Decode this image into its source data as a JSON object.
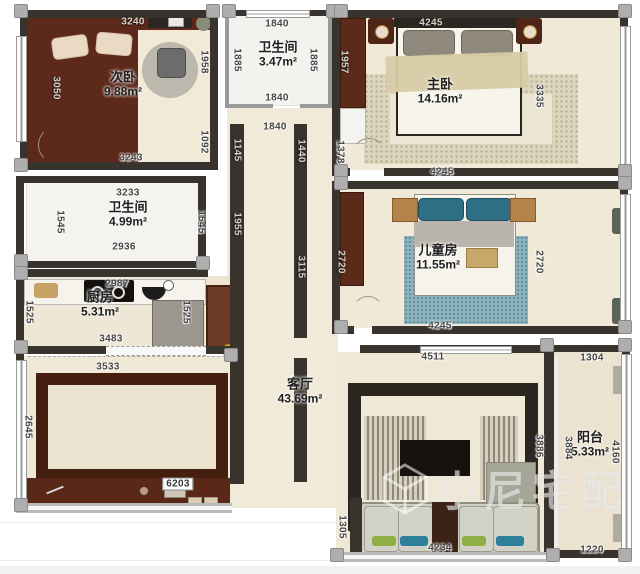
{
  "plan": {
    "watermark": {
      "text": "小尼宅配"
    },
    "rooms": [
      {
        "key": "secondary-bedroom",
        "name": "次卧",
        "area": "9.88m²",
        "x": 123,
        "y": 85
      },
      {
        "key": "bathroom-top",
        "name": "卫生间",
        "area": "3.47m²",
        "x": 278,
        "y": 55
      },
      {
        "key": "master-bedroom",
        "name": "主卧",
        "area": "14.16m²",
        "x": 440,
        "y": 92
      },
      {
        "key": "bathroom-left",
        "name": "卫生间",
        "area": "4.99m²",
        "x": 128,
        "y": 215
      },
      {
        "key": "kitchen",
        "name": "厨房",
        "area": "5.31m²",
        "x": 100,
        "y": 305
      },
      {
        "key": "children-room",
        "name": "儿童房",
        "area": "11.55m²",
        "x": 438,
        "y": 258
      },
      {
        "key": "living-room",
        "name": "客厅",
        "area": "43.69m²",
        "x": 300,
        "y": 392
      },
      {
        "key": "balcony",
        "name": "阳台",
        "area": "5.33m²",
        "x": 590,
        "y": 445
      }
    ],
    "dimensions": [
      {
        "value": "3240",
        "x": 133,
        "y": 22,
        "dark": true
      },
      {
        "value": "1840",
        "x": 277,
        "y": 24
      },
      {
        "value": "4245",
        "x": 431,
        "y": 23,
        "dark": true
      },
      {
        "value": "3050",
        "x": 56,
        "y": 88,
        "vert": true,
        "dark": true
      },
      {
        "value": "1958",
        "x": 204,
        "y": 62,
        "vert": true
      },
      {
        "value": "1885",
        "x": 237,
        "y": 60,
        "vert": true
      },
      {
        "value": "1885",
        "x": 313,
        "y": 60,
        "vert": true
      },
      {
        "value": "1957",
        "x": 344,
        "y": 62,
        "vert": true,
        "dark": true
      },
      {
        "value": "3335",
        "x": 539,
        "y": 96,
        "vert": true
      },
      {
        "value": "1840",
        "x": 277,
        "y": 98
      },
      {
        "value": "1092",
        "x": 204,
        "y": 142,
        "vert": true
      },
      {
        "value": "3243",
        "x": 131,
        "y": 158
      },
      {
        "value": "1840",
        "x": 275,
        "y": 127
      },
      {
        "value": "1145",
        "x": 237,
        "y": 150,
        "vert": true,
        "dark": true
      },
      {
        "value": "1440",
        "x": 301,
        "y": 151,
        "vert": true,
        "dark": true
      },
      {
        "value": "1378",
        "x": 340,
        "y": 152,
        "vert": true
      },
      {
        "value": "4245",
        "x": 442,
        "y": 172
      },
      {
        "value": "3233",
        "x": 128,
        "y": 193
      },
      {
        "value": "1545",
        "x": 60,
        "y": 222,
        "vert": true
      },
      {
        "value": "1545",
        "x": 201,
        "y": 222,
        "vert": true
      },
      {
        "value": "1955",
        "x": 237,
        "y": 224,
        "vert": true,
        "dark": true
      },
      {
        "value": "2936",
        "x": 124,
        "y": 247
      },
      {
        "value": "3115",
        "x": 301,
        "y": 267,
        "vert": true,
        "dark": true
      },
      {
        "value": "2720",
        "x": 341,
        "y": 262,
        "vert": true,
        "dark": true
      },
      {
        "value": "2720",
        "x": 539,
        "y": 262,
        "vert": true
      },
      {
        "value": "2987",
        "x": 117,
        "y": 284
      },
      {
        "value": "1525",
        "x": 29,
        "y": 312,
        "vert": true
      },
      {
        "value": "1525",
        "x": 186,
        "y": 312,
        "vert": true
      },
      {
        "value": "3483",
        "x": 111,
        "y": 339
      },
      {
        "value": "4245",
        "x": 440,
        "y": 326
      },
      {
        "value": "3533",
        "x": 108,
        "y": 367
      },
      {
        "value": "4511",
        "x": 433,
        "y": 357
      },
      {
        "value": "1304",
        "x": 592,
        "y": 358
      },
      {
        "value": "2645",
        "x": 28,
        "y": 427,
        "vert": true
      },
      {
        "value": "3884",
        "x": 568,
        "y": 448,
        "vert": true
      },
      {
        "value": "4160",
        "x": 615,
        "y": 452,
        "vert": true
      },
      {
        "value": "3886",
        "x": 539,
        "y": 446,
        "vert": true
      },
      {
        "value": "1305",
        "x": 342,
        "y": 527,
        "vert": true
      },
      {
        "value": "6203",
        "x": 178,
        "y": 484,
        "boxed": true
      },
      {
        "value": "4234",
        "x": 440,
        "y": 548
      },
      {
        "value": "1220",
        "x": 592,
        "y": 550
      }
    ],
    "layout": {
      "columns": [
        [
          14,
          4
        ],
        [
          206,
          4
        ],
        [
          222,
          4
        ],
        [
          326,
          4
        ],
        [
          334,
          4
        ],
        [
          618,
          4
        ],
        [
          14,
          158
        ],
        [
          14,
          254
        ],
        [
          14,
          266
        ],
        [
          14,
          340
        ],
        [
          14,
          498
        ],
        [
          196,
          256
        ],
        [
          334,
          164
        ],
        [
          618,
          164
        ],
        [
          334,
          176
        ],
        [
          618,
          176
        ],
        [
          334,
          320
        ],
        [
          618,
          320
        ],
        [
          540,
          338
        ],
        [
          618,
          338
        ],
        [
          546,
          548
        ],
        [
          618,
          548
        ],
        [
          224,
          348
        ],
        [
          330,
          548
        ]
      ]
    }
  }
}
